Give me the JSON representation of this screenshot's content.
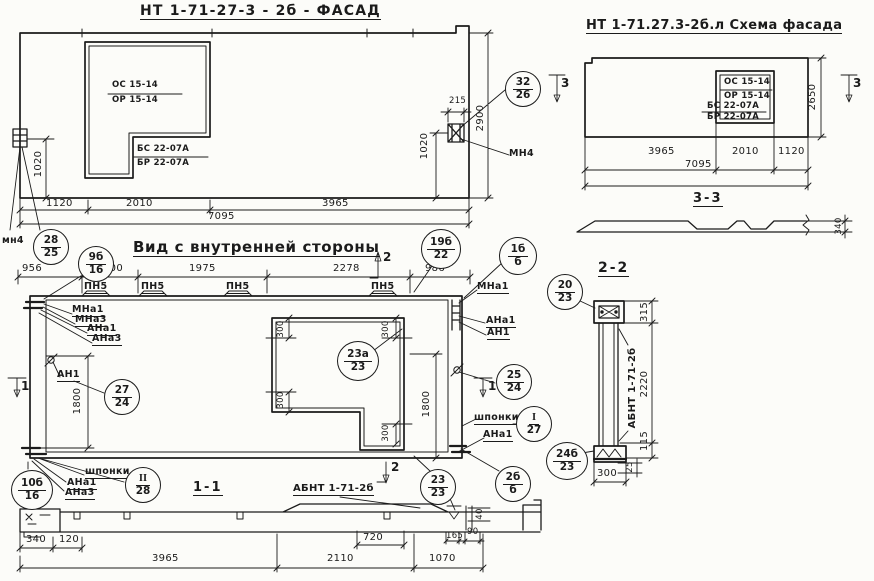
{
  "facade": {
    "title": "НТ 1-71-27-3 - 2б - ФАСАД",
    "window": {
      "os": "ОС 15-14",
      "or": "ОР 15-14",
      "bs": "БС 22-07А",
      "br": "БР 22-07А"
    },
    "dims": {
      "d215": "215",
      "d2900": "2900",
      "d1020_left": "1020",
      "d1020_right": "1020",
      "d1120": "1120",
      "d2010": "2010",
      "d3965": "3965",
      "d7095": "7095"
    },
    "labels": {
      "mn4_left": "мн4",
      "mn4_right": "МН4"
    },
    "callouts": {
      "c32_26": {
        "top": "32",
        "bottom": "26"
      },
      "c28_25": {
        "top": "28",
        "bottom": "25"
      }
    }
  },
  "scheme": {
    "title": "НТ 1-71.27.3-2б.л Схема фасада",
    "window": {
      "os": "ОС 15-14",
      "or": "ОР 15-14",
      "bs": "БС 22-07А",
      "br": "БР 22-07А"
    },
    "dims": {
      "d2650": "2650",
      "d3965": "3965",
      "d2010": "2010",
      "d1120": "1120",
      "d7095": "7095",
      "d340": "340"
    },
    "section_marks": {
      "left": "3",
      "right": "3"
    },
    "section_33": {
      "title": "3-3"
    }
  },
  "inner_view": {
    "title": "Вид с внутренней стороны",
    "dims_top": [
      "956",
      "900",
      "1975",
      "2278",
      "986"
    ],
    "pn5_labels": [
      "ПН5",
      "ПН5",
      "ПН5",
      "ПН5"
    ],
    "left_labels": {
      "mna1": "МНа1",
      "mna3": "МНа3",
      "ana1": "АНа1",
      "ana3": "АНа3",
      "an1": "АН1"
    },
    "right_labels": {
      "mna1": "МНа1",
      "ana1": "АНа1",
      "an1": "АН1",
      "shponki": "шпонки",
      "ana1_lower": "АНа1"
    },
    "bottom_labels": {
      "shponki": "шпонки",
      "ana1": "АНа1",
      "ana3": "АНа3"
    },
    "dims": {
      "d1800_left": "1800",
      "d1800_right": "1800",
      "d300_top_left": "300",
      "d300_top_right": "300",
      "d300_mid_left": "300",
      "d300_bottom": "300"
    },
    "section_marks": {
      "top": "2",
      "left": "1",
      "right": "1"
    },
    "callouts": {
      "c9b_16": {
        "top": "9б",
        "bottom": "16"
      },
      "c19b_22": {
        "top": "19б",
        "bottom": "22"
      },
      "c1b_b": {
        "top": "1б",
        "bottom": "б"
      },
      "c27_24": {
        "top": "27",
        "bottom": "24"
      },
      "c23a_23": {
        "top": "23а",
        "bottom": "23"
      },
      "c25_24": {
        "top": "25",
        "bottom": "24"
      },
      "cI_27": {
        "top": "I",
        "bottom": "27"
      },
      "cII_28": {
        "top": "II",
        "bottom": "28"
      },
      "c10b_16": {
        "top": "10б",
        "bottom": "16"
      },
      "c23_23": {
        "top": "23",
        "bottom": "23"
      },
      "c2b_b": {
        "top": "2б",
        "bottom": "б"
      }
    }
  },
  "section_11": {
    "title": "1-1",
    "beam_label": "АБНТ 1-71-2б",
    "section_mark": "2",
    "dims": {
      "d340": "340",
      "d120": "120",
      "d3965": "3965",
      "d720": "720",
      "d2110": "2110",
      "d1070": "1070",
      "d165": "165",
      "d90": "90",
      "d40": "40"
    }
  },
  "section_22": {
    "title": "2-2",
    "beam_label": "АБНТ 1-71-2б",
    "dims": {
      "d315": "315",
      "d2220": "2220",
      "d115": "115",
      "d25": "25",
      "d300": "300"
    },
    "callouts": {
      "c20_23": {
        "top": "20",
        "bottom": "23"
      },
      "c24b_23": {
        "top": "24б",
        "bottom": "23"
      }
    }
  }
}
